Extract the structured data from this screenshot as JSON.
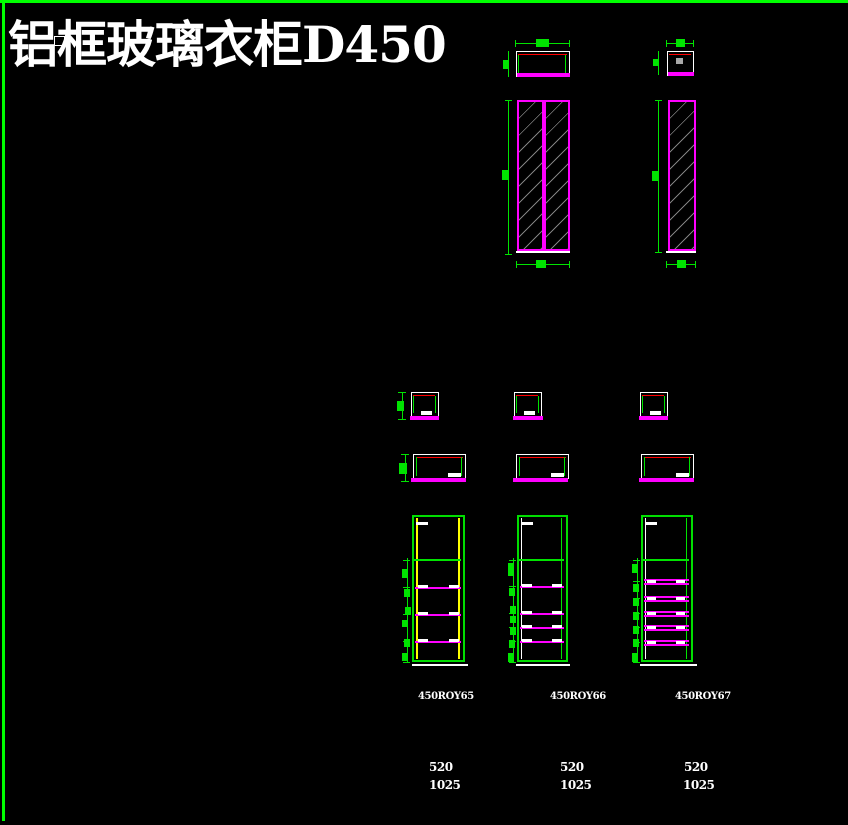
{
  "drawing": {
    "title": "铝框玻璃衣柜D450"
  },
  "columns": [
    {
      "code": "450ROY65",
      "width": "520",
      "height": "1025"
    },
    {
      "code": "450ROY66",
      "width": "520",
      "height": "1025"
    },
    {
      "code": "450ROY67",
      "width": "520",
      "height": "1025"
    }
  ],
  "colors": {
    "background": "#000000",
    "frame_green": "#00dd00",
    "dimension_green": "#00e400",
    "panel_magenta": "#ff00ff",
    "edge_red": "#ff0000",
    "profile_yellow": "#ffff00",
    "glass_hatch_gray": "#969696",
    "text_white": "#ffffff"
  }
}
